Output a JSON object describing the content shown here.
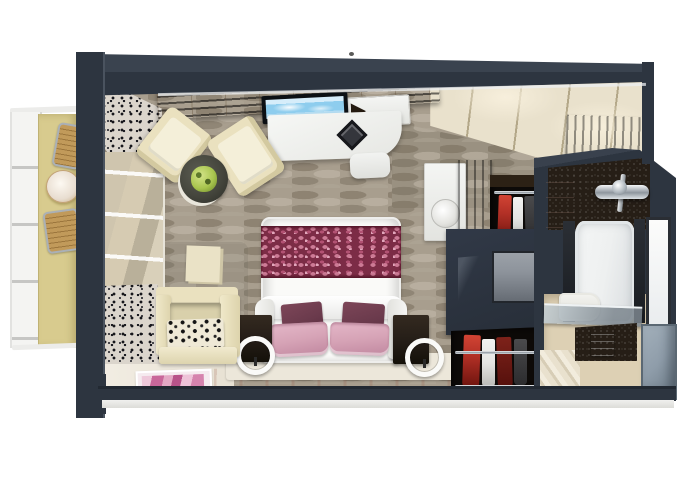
{
  "scene": {
    "kind": "3d-rendered-cruise-suite-floorplan",
    "areas": [
      "balcony",
      "sitting-area",
      "bedroom",
      "dressing-area",
      "bathroom",
      "entry"
    ]
  },
  "palette": {
    "wall": "#2d3540",
    "trim": "#e7e9eb",
    "carpet": "#a89e8e",
    "wallpaper": "#9a9181",
    "corridor": "#e9e1cc",
    "corridorGlow": "#f7efdc",
    "corridorSeam": "#b3a788",
    "balconyFloor": "#d8cb8e",
    "rail": "#f4f4f2",
    "cream": "#eae1bf",
    "creamDeep": "#d3c9a0",
    "creamLight": "#f4efd9",
    "curtain": "#dbd5cc",
    "curtainDot": "#17171c",
    "glassBeige": "#d6cbb2",
    "bedWhite": "#fafaf8",
    "runnerBase": "#7c2c46",
    "runnerPink": "#cd7b96",
    "runnerRose": "#b25273",
    "runnerLight": "#e2a6bb",
    "pink": "#d6a3b6",
    "pinkDeep": "#c0879f",
    "plum": "#6a3a4c",
    "nightstand": "#241d17",
    "platform": "#ece7da",
    "darkFloor": "#1b120d",
    "matBase": "#f5ebef",
    "matPink": "#c9679a",
    "closet": "#0d0a08",
    "garmentRed": "#b23026",
    "garmentWhite": "#e4e4e2",
    "navy": "#313947",
    "counter": "#141a20",
    "mirror": "#8d939b",
    "mosaic": "#261e16",
    "bathTile": "#d5c2b9",
    "tub": "#eef0f0",
    "bathFloor": "#ddd0b4",
    "marble": "#e9e1ce",
    "grayBox": "#8f9daa",
    "sky": "#8ecdee",
    "skyLight": "#d6edfa",
    "plant": "#a9c54f",
    "plantDark": "#5f7a2b",
    "tableTop": "#45463d",
    "chairWood": "#c19a5a",
    "metal": "#aab0b6",
    "art": "#eae2c6"
  }
}
